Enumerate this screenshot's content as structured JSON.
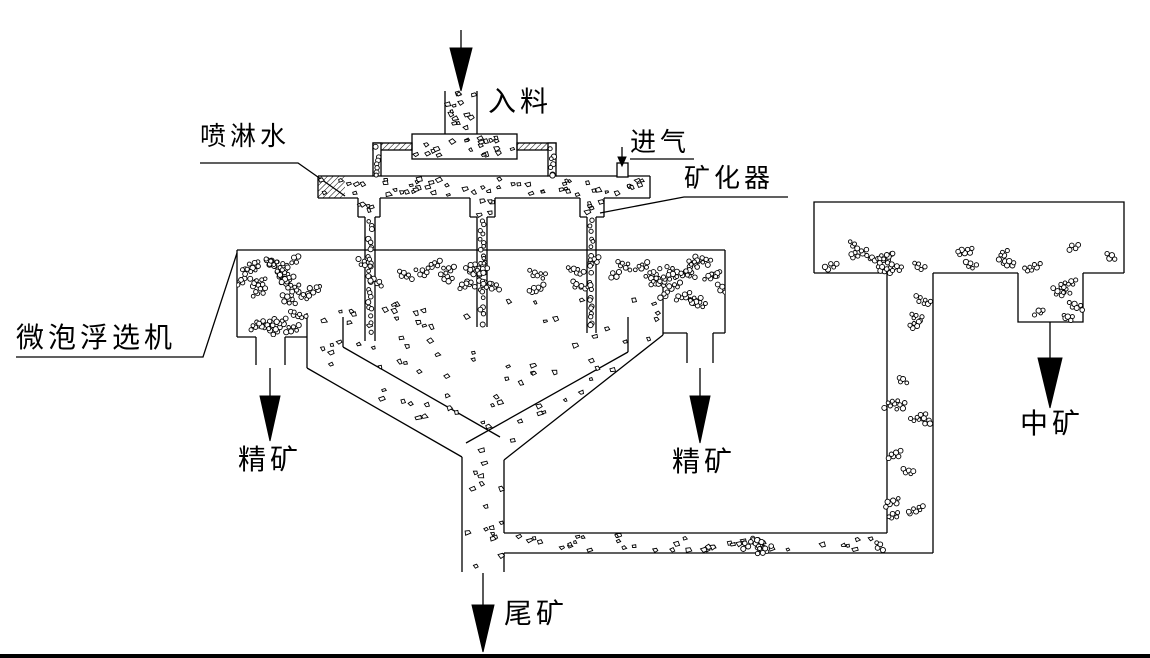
{
  "labels": {
    "feed": "入料",
    "spray_water": "喷淋水",
    "air_inlet": "进气",
    "mineralizer": "矿化器",
    "flotation_machine": "微泡浮选机",
    "concentrate_left": "精矿",
    "concentrate_right": "精矿",
    "middlings": "中矿",
    "tailings": "尾矿"
  },
  "colors": {
    "line": "#000000",
    "background": "#ffffff"
  }
}
